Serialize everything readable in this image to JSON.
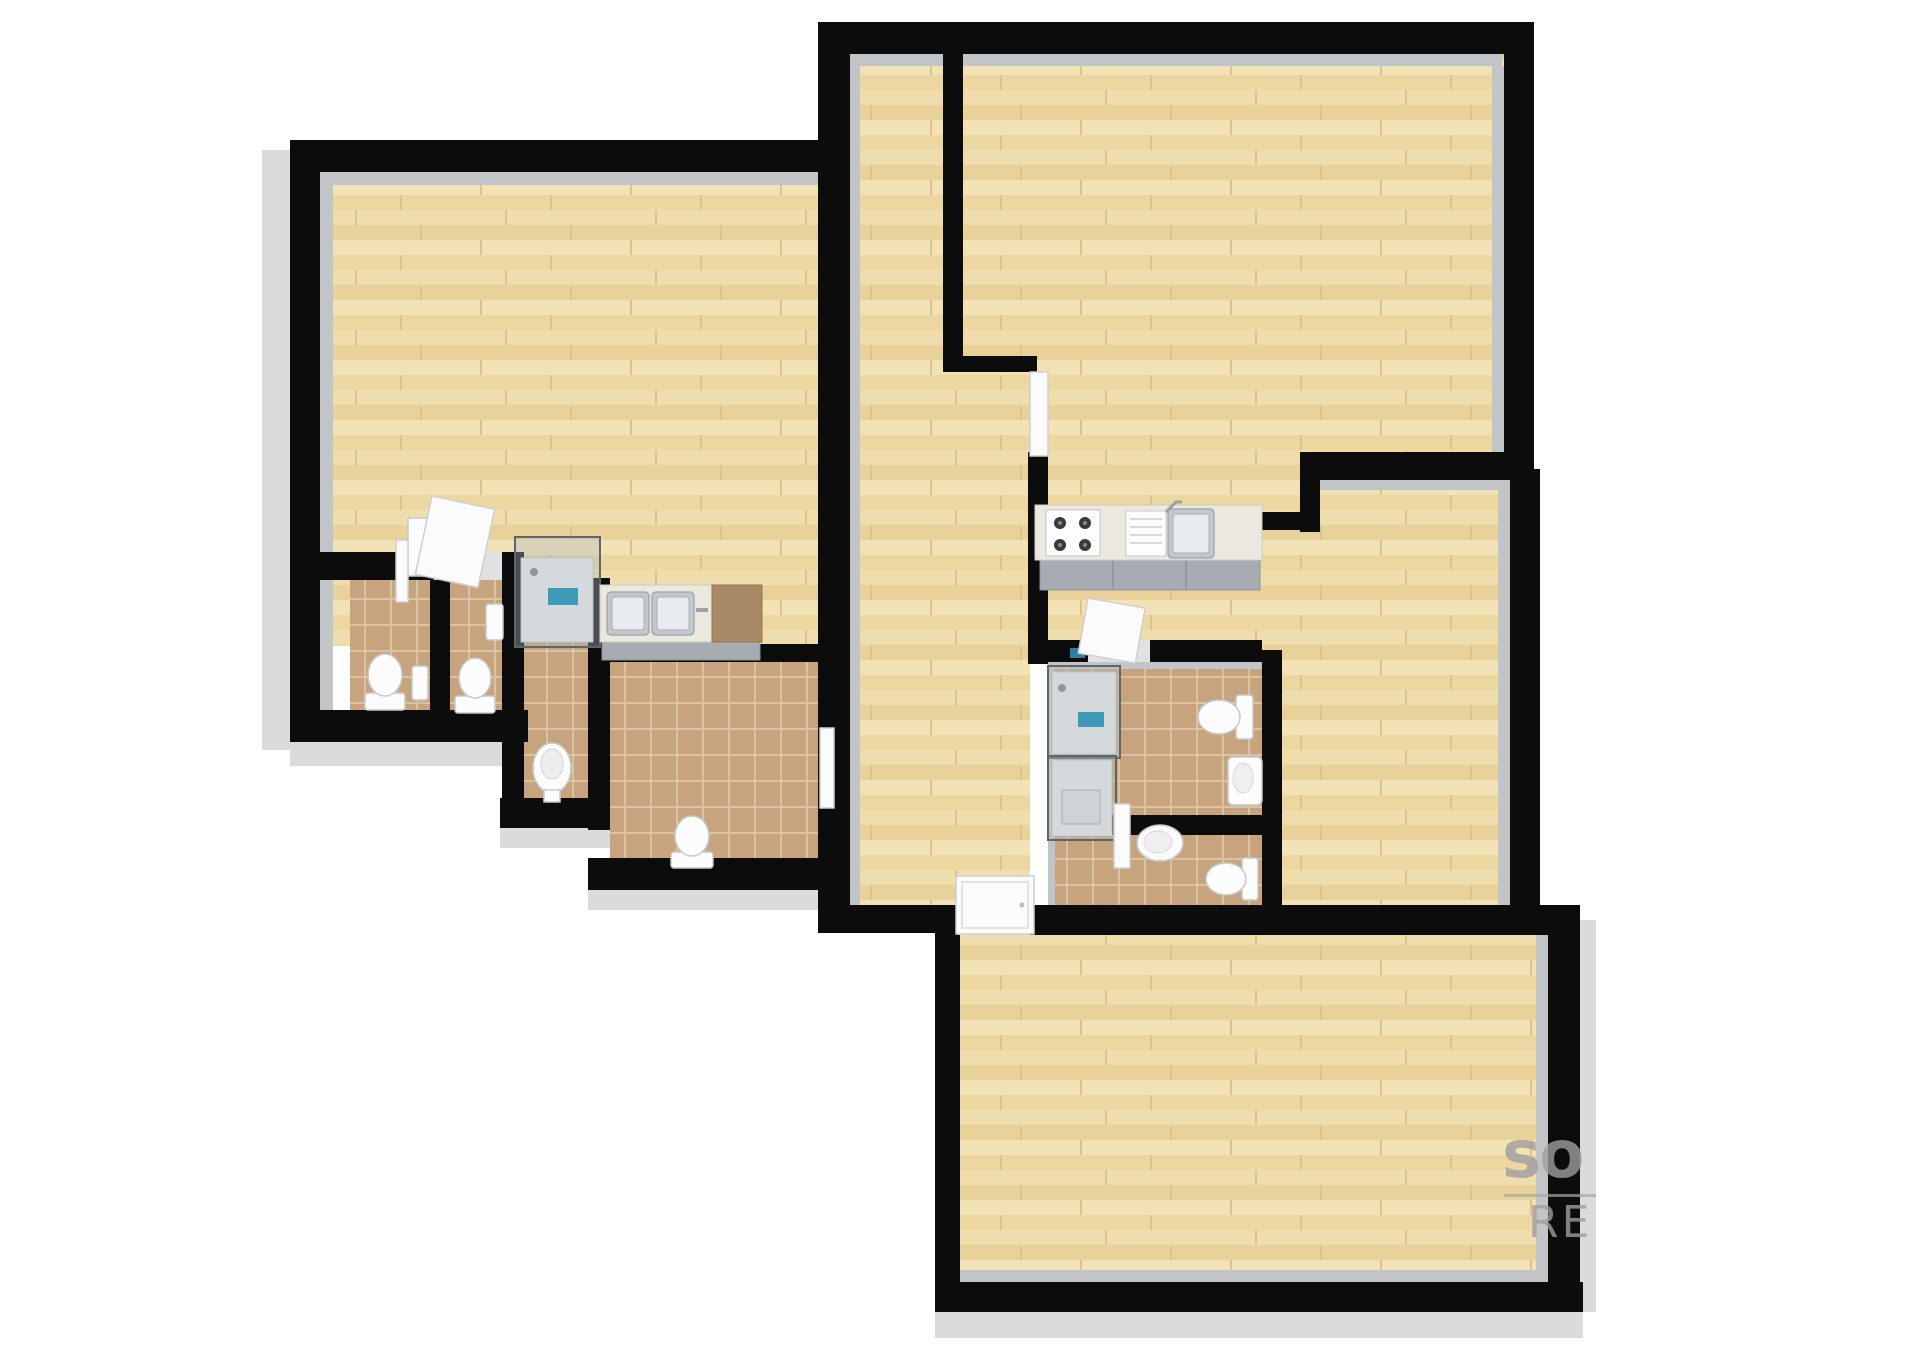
{
  "watermark": {
    "line1": "so",
    "line2": "RE"
  },
  "palette": {
    "background": "#ffffff",
    "wall": "#0c0c0c",
    "wall_inner_ledge": "#c2c5c8",
    "wall_outer_face": "#d9dbdd",
    "wood_floor": "#eedaa9",
    "tile_floor": "#c7a47e",
    "fixture_white": "#fcfcfc",
    "steel": "#c2c8cc",
    "counter_top": "#eae8df",
    "counter_wood_section": "#a98a66",
    "cabinet_front": "#a6acb1",
    "shower_glass": "#aeb8bd",
    "shower_mat_blue": "#3f9ab8",
    "watermark_gray": "#9e9e9e"
  },
  "plan": {
    "type": "3d-floor-plan-top-down-render",
    "units": [
      {
        "name": "left-studio",
        "rooms": [
          {
            "name": "main-room",
            "floor": "wood",
            "fixtures": [
              "bathroom-door",
              "glass-shower-cabin",
              "double-sink-counter",
              "wardrobe-closet"
            ]
          },
          {
            "name": "wc-1",
            "floor": "tile",
            "fixtures": [
              "toilet",
              "hand-sink"
            ]
          },
          {
            "name": "wc-2",
            "floor": "tile",
            "fixtures": [
              "toilet",
              "hand-sink"
            ]
          },
          {
            "name": "shower-room",
            "floor": "tile",
            "fixtures": [
              "bidet"
            ]
          },
          {
            "name": "bathroom-right",
            "floor": "tile",
            "fixtures": [
              "toilet"
            ]
          }
        ]
      },
      {
        "name": "right-apartment",
        "rooms": [
          {
            "name": "hallway",
            "floor": "wood",
            "fixtures": [
              "entrance-door",
              "kitchen-door",
              "side-door"
            ]
          },
          {
            "name": "living-room",
            "floor": "wood",
            "fixtures": []
          },
          {
            "name": "kitchen",
            "floor": "wood",
            "fixtures": [
              "gas-hob-4-burner",
              "sink-with-drainer",
              "base-cabinets"
            ]
          },
          {
            "name": "middle-room",
            "floor": "wood",
            "fixtures": []
          },
          {
            "name": "bathroom-upper",
            "floor": "tile",
            "fixtures": [
              "glass-shower-cabin",
              "toilet",
              "wash-basin",
              "door"
            ]
          },
          {
            "name": "bathroom-lower",
            "floor": "tile",
            "fixtures": [
              "shower-cabin",
              "toilet",
              "wash-basin",
              "door"
            ]
          },
          {
            "name": "bottom-room",
            "floor": "wood",
            "fixtures": []
          }
        ]
      }
    ]
  }
}
